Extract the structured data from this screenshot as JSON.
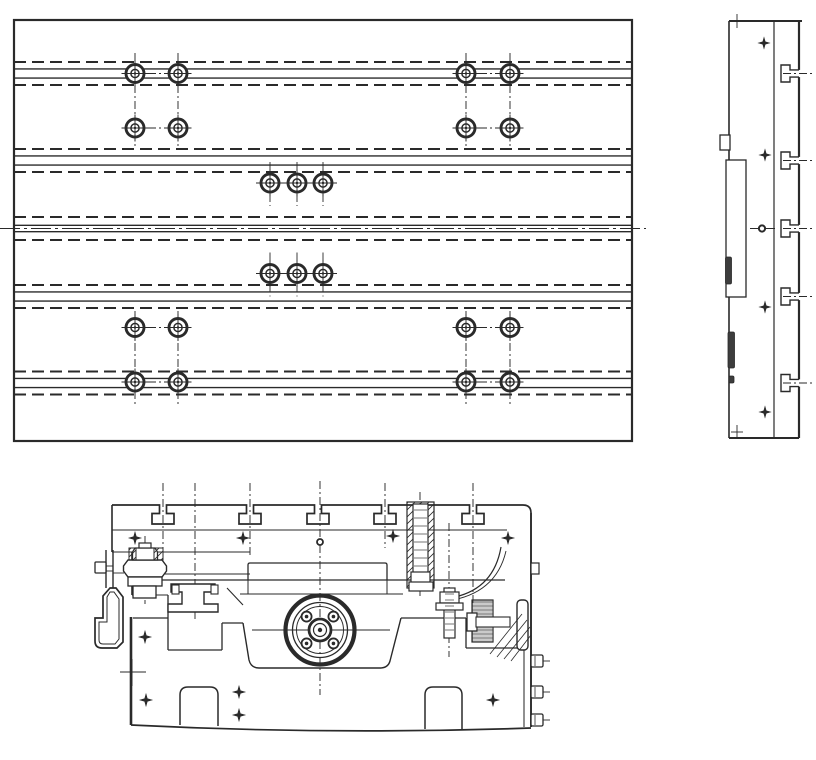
{
  "drawing": {
    "ink": "#2a2a2a",
    "bg": "#ffffff",
    "canvas": {
      "w": 816,
      "h": 760
    },
    "plan_view": {
      "frame": {
        "x": 14,
        "y": 20,
        "w": 618,
        "h": 421
      },
      "t_slot_bands": {
        "centers_y": [
          73.5,
          160.5,
          228.5,
          296.5,
          383
        ],
        "dashed_offset": 11.5,
        "solid_offset": 4.6,
        "center_band_solid_offset": 3.2,
        "dash_pattern": "12 6"
      },
      "table_centerline": {
        "y": 228.5,
        "x1": 0,
        "x2": 646,
        "dash": "20 4 3 4"
      },
      "bolt_style": {
        "r_outer": 9,
        "r_inner": 4.1,
        "r_dot": 1.2,
        "cross_len": 13.5
      },
      "bolt_pairs": {
        "xs": [
          [
            135,
            178
          ],
          [
            466,
            510
          ]
        ],
        "rows_y": [
          73.5,
          128,
          327.5,
          382
        ],
        "v_centerline_top": [
          53,
          146
        ],
        "v_centerline_bottom": [
          311,
          404
        ]
      },
      "bolt_triples": {
        "xs": [
          270,
          297,
          323
        ],
        "rows_y": [
          183,
          273.5
        ],
        "h_line": [
          256,
          337
        ],
        "v_ext": [
          21,
          23
        ]
      }
    },
    "side_view": {
      "left": 729,
      "top": 21,
      "right": 799,
      "bottom": 438,
      "inner_line_x": 774,
      "top_edge_overhang": 802,
      "t_slots": {
        "centers_y": [
          73.5,
          160.5,
          228.5,
          296.5,
          383
        ],
        "neck_hw": 3.6,
        "chan_hw": 8.5,
        "neck_x": 790,
        "chan_x": 781,
        "dashdot_x2": 812
      },
      "tab": {
        "x": 720,
        "y": 135,
        "w": 10,
        "h": 15
      },
      "plate": {
        "x": 726,
        "y": 160,
        "w": 20,
        "h": 137
      },
      "dark_bars": [
        [
          725.5,
          257,
          6,
          27
        ],
        [
          728,
          332,
          6.5,
          36
        ],
        [
          729,
          376,
          5,
          7
        ]
      ],
      "stars": [
        [
          764,
          43
        ],
        [
          765,
          155
        ],
        [
          765,
          307
        ],
        [
          765,
          412
        ]
      ],
      "center_hole": {
        "x": 762,
        "y": 228.5,
        "r": 3.1,
        "line_x1": 750,
        "line_x2": 775
      },
      "ticks": [
        [
          737,
          21
        ],
        [
          737,
          432
        ]
      ]
    },
    "section_view": {
      "center_x": 320,
      "top_notches_x": [
        163,
        250,
        318,
        385,
        473
      ],
      "notch": {
        "neck_hw": 3.5,
        "chan_hw": 11,
        "neck_y2": 513.5,
        "chan_y2": 524,
        "top_y": 505
      },
      "top_outline": {
        "x_start": 112,
        "x_corner": 523,
        "corner_r": 8,
        "right_x": 531
      },
      "solid_lines": [
        [
          112,
          530,
          507,
          530,
          1.1
        ],
        [
          112,
          552,
          250,
          552,
          1.1
        ],
        [
          132,
          574,
          250,
          574,
          1.0
        ],
        [
          132,
          580,
          505,
          580,
          1.35
        ],
        [
          240,
          594,
          403,
          594,
          1.0
        ],
        [
          132,
          595,
          168,
          595,
          1.0
        ],
        [
          112,
          505,
          112,
          552,
          1.6
        ],
        [
          132,
          552,
          132,
          595,
          1.6
        ],
        [
          131,
          617,
          131,
          725,
          2.6
        ],
        [
          133,
          618,
          168,
          618,
          1.3
        ],
        [
          168,
          595,
          168,
          650,
          1.3
        ],
        [
          168,
          650,
          222,
          650,
          1.3
        ],
        [
          222,
          623,
          222,
          650,
          1.3
        ],
        [
          222,
          623,
          243,
          623,
          1.3
        ],
        [
          401,
          618,
          466,
          618,
          1.3
        ],
        [
          466,
          618,
          466,
          648,
          1.3
        ],
        [
          466,
          648,
          524,
          648,
          1.2
        ],
        [
          531,
          513,
          531,
          727,
          1.9
        ],
        [
          524,
          600,
          524,
          727,
          1.05
        ],
        [
          248,
          580,
          248,
          594,
          1.0
        ],
        [
          387,
          580,
          387,
          594,
          1.0
        ],
        [
          120,
          672,
          146,
          672,
          0.9
        ],
        [
          132,
          659,
          132,
          686,
          0.9
        ],
        [
          106,
          550,
          106,
          588,
          1.4
        ],
        [
          113,
          550,
          113,
          588,
          1.4
        ],
        [
          106,
          566,
          113,
          566,
          0.9
        ],
        [
          106,
          571,
          113,
          571,
          0.9
        ],
        [
          113,
          573,
          124,
          573,
          0.9
        ],
        [
          252,
          630,
          390,
          630,
          0.9
        ],
        [
          543,
          661,
          550,
          661,
          0.9
        ],
        [
          543,
          692,
          550,
          692,
          0.9
        ],
        [
          543,
          720,
          550,
          720,
          0.9
        ],
        [
          227,
          588,
          243,
          605,
          1.1
        ],
        [
          476,
          622,
          510,
          622,
          0.7
        ]
      ],
      "paths": [
        {
          "n": "section-bottom-edge",
          "d": "M 131,725 Q 330,735 531,728",
          "w": 1.7
        },
        {
          "n": "saddle-trough",
          "d": "M 243,623 L 249,660 Q 251,668 259,668 L 380,668 Q 388,668 390,661 L 401,618",
          "w": 1.4
        },
        {
          "n": "foot-notch-left",
          "d": "M 180,725 L 180,695 Q 180,687 188,687 L 210,687 Q 218,687 218,695 L 218,726",
          "w": 1.5
        },
        {
          "n": "foot-notch-right",
          "d": "M 425,729 L 425,695 Q 425,687 433,687 L 454,687 Q 462,687 462,695 L 462,729",
          "w": 1.5
        },
        {
          "n": "raised-bar",
          "d": "M 248,580 L 248,565 Q 248,563 250,563 L 385,563 Q 387,563 387,565 L 387,580",
          "w": 1.3
        },
        {
          "n": "lifting-hook",
          "d": "M 110,588 L 103,596 L 103,618 L 95,618 L 95,641 Q 95,648 102,648 L 117,648 L 123,642 L 123,597 L 116,588 Z",
          "w": 1.7,
          "f": "#fff"
        },
        {
          "n": "lifting-hook-inner",
          "d": "M 110,592 L 107,597 L 107,622 L 99,622 L 99,640 Q 99,644 103,644 L 115,644 L 119,639 L 119,599 L 114,592 Z",
          "w": 1.0
        },
        {
          "n": "clamp-nut-hex",
          "d": "M 128,560 L 162,560 L 166.5,566 L 166.5,571 L 162,577 L 128,577 L 123.5,571 L 123.5,566 Z",
          "w": 1.4,
          "f": "#fff"
        },
        {
          "n": "clamp-bolt-head",
          "d": "M 135,548 L 155,548 L 157.5,552 L 157.5,560 L 132.5,560 L 132.5,552 Z",
          "w": 1.3,
          "f": "#fff"
        },
        {
          "n": "clamp-spool",
          "d": "M 171,584 L 215,584 L 215,592 L 204,592 L 204,604 L 218,604 L 218,612 L 168,612 L 168,604 L 182,604 L 182,592 L 171,592 Z",
          "w": 1.4,
          "f": "#fff"
        },
        {
          "n": "apron-arc-outer",
          "d": "M 455,597 Q 494,588 501,547",
          "w": 1.2
        },
        {
          "n": "apron-arc-inner",
          "d": "M 447,601 Q 496,594 506,551",
          "w": 0.9
        }
      ],
      "rects": [
        {
          "n": "bolt-cap",
          "x": 139,
          "y": 543,
          "w": 12,
          "h": 5,
          "sw": 1.2,
          "f": "#fff"
        },
        {
          "n": "washer",
          "x": 128,
          "y": 577,
          "w": 34,
          "h": 9,
          "sw": 1.3,
          "f": "#fff"
        },
        {
          "n": "cylinder",
          "x": 133,
          "y": 586,
          "w": 23,
          "h": 12,
          "sw": 1.3,
          "f": "#fff"
        },
        {
          "n": "hook-pin-head",
          "x": 95,
          "y": 562,
          "w": 11,
          "h": 11,
          "sw": 1.3,
          "rx": 1,
          "f": "#fff"
        },
        {
          "n": "clamp-key-left",
          "x": 172,
          "y": 585,
          "w": 7,
          "h": 9,
          "sw": 1.1,
          "f": "#fff"
        },
        {
          "n": "clamp-key-right",
          "x": 211,
          "y": 585,
          "w": 7,
          "h": 9,
          "sw": 1.1,
          "f": "#fff"
        },
        {
          "n": "hatched-bore",
          "x": 407,
          "y": 502,
          "w": 27,
          "h": 86,
          "sw": 1.2,
          "f": "hatch"
        },
        {
          "n": "vertical-bolt",
          "x": 413,
          "y": 504,
          "w": 15,
          "h": 80,
          "sw": 1.2,
          "f": "#fff"
        },
        {
          "n": "vertical-bolt-nut",
          "x": 411,
          "y": 572,
          "w": 19,
          "h": 12,
          "sw": 1.2,
          "f": "#fff"
        },
        {
          "n": "vertical-bolt-washer",
          "x": 409,
          "y": 582,
          "w": 24,
          "h": 9,
          "sw": 1.2,
          "f": "#fff"
        },
        {
          "n": "stud",
          "x": 444,
          "y": 588,
          "w": 11,
          "h": 50,
          "sw": 1.2,
          "f": "#fff"
        },
        {
          "n": "stud-nut",
          "x": 440,
          "y": 592,
          "w": 19,
          "h": 11,
          "sw": 1.2,
          "f": "#fff"
        },
        {
          "n": "stud-washer",
          "x": 436,
          "y": 603,
          "w": 27,
          "h": 7,
          "sw": 1.2,
          "f": "#fff"
        },
        {
          "n": "knurled-strip",
          "x": 472,
          "y": 600,
          "w": 21,
          "h": 42,
          "sw": 1.2,
          "f": "knurl"
        },
        {
          "n": "h-bolt-head",
          "x": 467,
          "y": 613,
          "w": 10,
          "h": 18,
          "sw": 1.3,
          "f": "#fff"
        },
        {
          "n": "h-bolt-shank",
          "x": 476,
          "y": 617,
          "w": 34,
          "h": 10,
          "sw": 1.1,
          "f": "#fff"
        },
        {
          "n": "edge-tab",
          "x": 531,
          "y": 563,
          "w": 8,
          "h": 11,
          "sw": 1.2,
          "f": "#fff"
        },
        {
          "n": "gib-bar",
          "x": 517,
          "y": 600,
          "w": 11,
          "h": 50,
          "sw": 1.4,
          "rx": 4,
          "f": "#fff"
        },
        {
          "n": "hatch-wedge-left",
          "x": 129,
          "y": 548,
          "w": 7,
          "h": 12,
          "sw": 1.0,
          "f": "hatch"
        },
        {
          "n": "hatch-wedge-right",
          "x": 154,
          "y": 548,
          "w": 9,
          "h": 12,
          "sw": 1.0,
          "f": "hatch"
        }
      ],
      "edge_bolts": [
        [
          531,
          655
        ],
        [
          531,
          686
        ],
        [
          531,
          714
        ]
      ],
      "edge_bolt_size": [
        12,
        12
      ],
      "threads": [
        {
          "x1": 414,
          "x2": 427,
          "y": 510,
          "step": 8,
          "n": 8,
          "w": 0.65
        },
        {
          "x1": 445,
          "x2": 454,
          "y": 594,
          "step": 6,
          "n": 7,
          "w": 0.65
        }
      ],
      "hatch_diagonals": [
        [
          490,
          654,
          522,
          614
        ],
        [
          497,
          657,
          527,
          620
        ],
        [
          504,
          659,
          530,
          627
        ],
        [
          511,
          661,
          531,
          635
        ]
      ],
      "dashdot_verticals": [
        [
          163,
          483,
          548
        ],
        [
          195,
          483,
          622
        ],
        [
          250,
          483,
          556
        ],
        [
          320,
          481,
          695
        ],
        [
          385,
          483,
          548
        ],
        [
          473,
          483,
          604
        ],
        [
          420,
          492,
          598
        ],
        [
          449,
          523,
          657
        ],
        [
          145,
          536,
          604
        ]
      ],
      "stars": [
        [
          135,
          538
        ],
        [
          243,
          538
        ],
        [
          393,
          536
        ],
        [
          508,
          538
        ],
        [
          145,
          637
        ],
        [
          146,
          700
        ],
        [
          239,
          692
        ],
        [
          239,
          715
        ],
        [
          493,
          700
        ]
      ],
      "small_hole": {
        "x": 320,
        "y": 542,
        "r": 3,
        "sw": 1.8
      },
      "flange": {
        "cx": 320,
        "cy": 630,
        "rings": [
          [
            34.5,
            4.2
          ],
          [
            27.5,
            1.3
          ],
          [
            23.5,
            0.95
          ]
        ],
        "hub_rings": [
          [
            11,
            2.8
          ],
          [
            6.5,
            1.2
          ]
        ],
        "hub_dot_r": 2.2,
        "bolt_circle_r": 19,
        "bolt_r": 5,
        "bolt_dot_r": 1.8,
        "bolt_angles_deg": [
          45,
          135,
          225,
          315
        ]
      }
    }
  }
}
